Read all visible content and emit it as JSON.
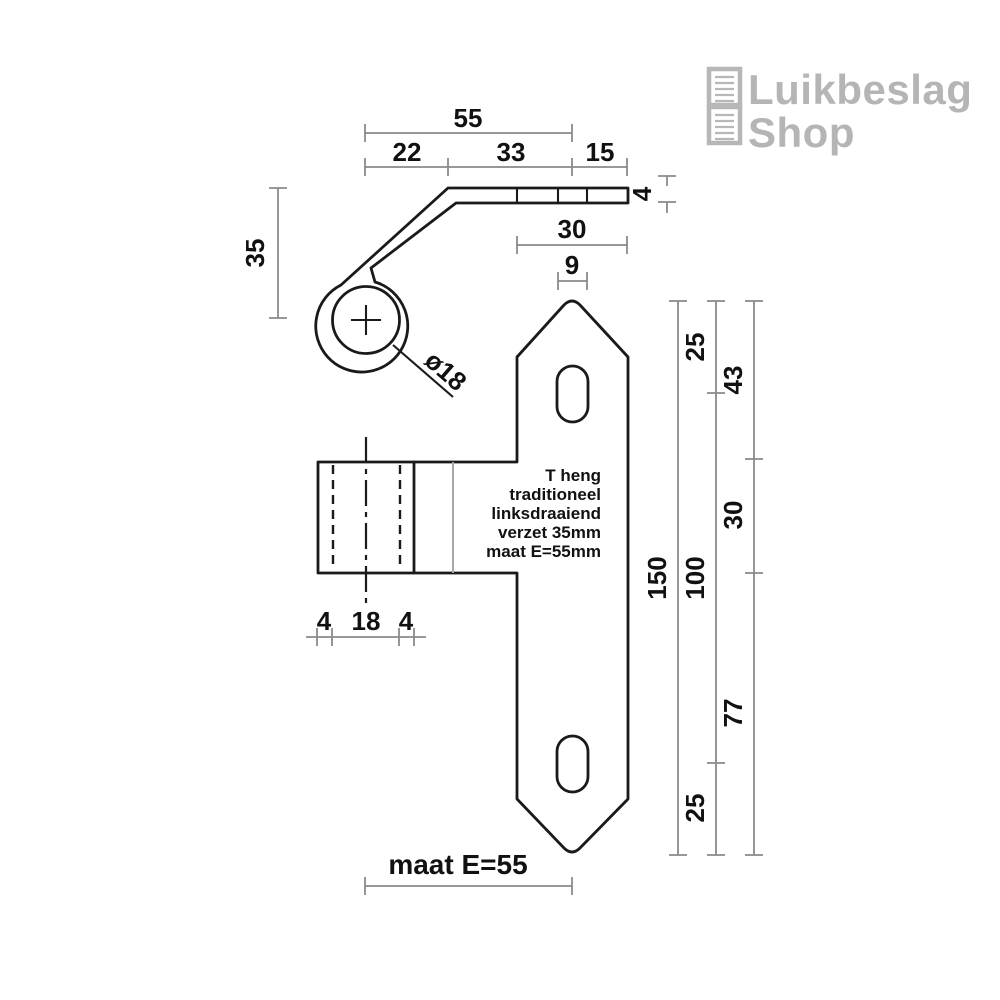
{
  "logo": {
    "line1": "Luikbeslag",
    "line2": "Shop",
    "icon": "shutter-panels-icon"
  },
  "drawing": {
    "product_label": {
      "lines": [
        "T heng",
        "traditioneel",
        "linksdraaiend",
        "verzet 35mm",
        "maat E=55mm"
      ]
    },
    "dims": {
      "total_width": "55",
      "bend_width": "22",
      "mid_width": "33",
      "end_width": "15",
      "strap_thickness": "4",
      "offset_height": "35",
      "plate_width": "30",
      "slot_width": "9",
      "pin_diameter": "ø18",
      "knuckle_left": "4",
      "knuckle_pin": "18",
      "knuckle_right": "4",
      "plate_height": "150",
      "top_hole_offset": "25",
      "hole_spacing": "100",
      "bottom_hole_offset": "25",
      "seg_top": "43",
      "seg_mid": "30",
      "seg_bottom": "77",
      "maat_e": "maat E=55"
    }
  },
  "colors": {
    "part_line": "#1a1a1a",
    "dimension_line": "#8a8a8a",
    "text": "#111111",
    "logo_gray": "#b5b5b5",
    "background": "#ffffff"
  }
}
